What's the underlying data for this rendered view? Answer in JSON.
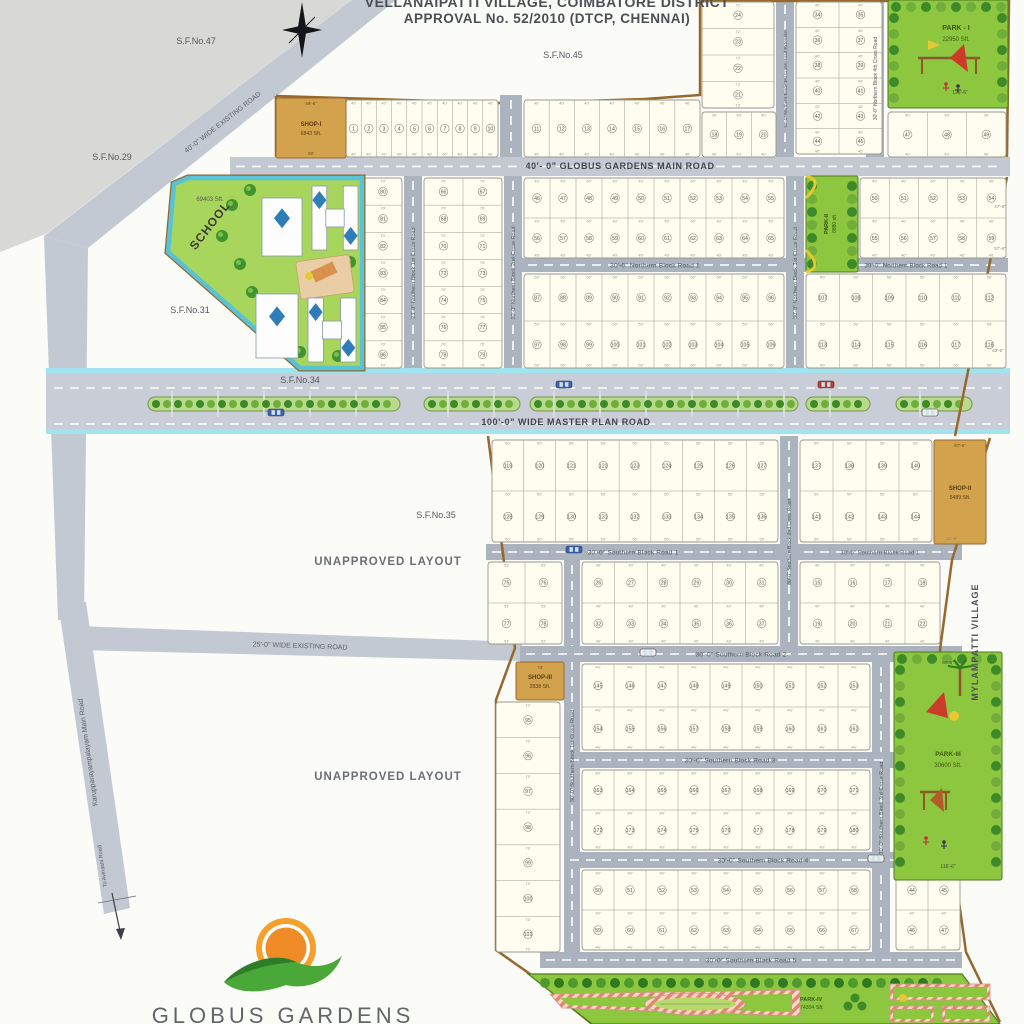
{
  "header": {
    "line1": "VELLANAIPATTI VILLAGE, COIMBATORE DISTRICT",
    "line2": "APPROVAL No. 52/2010 (DTCP, CHENNAI)"
  },
  "logo": {
    "name": "GLOBUS GARDENS"
  },
  "colors": {
    "road": "#c3c9d3",
    "road_dark": "#aab3be",
    "master_road": "#c8cdd7",
    "cyan": "#9fe4ee",
    "boundary": "#96682c",
    "plot_fill": "#fffdf0",
    "plot_stroke": "#9a9a8c",
    "park_green": "#8dc63f",
    "tree_dark": "#3c8a28",
    "tree_light": "#6fae3a",
    "shop_tan": "#d2a24c",
    "text": "#555555",
    "median_bg": "#b9d98c"
  },
  "map": {
    "labels": {
      "survey": [
        {
          "text": "S.F.No.47",
          "x": 196,
          "y": 44
        },
        {
          "text": "S.F.No.45",
          "x": 563,
          "y": 58
        },
        {
          "text": "S.F.No.29",
          "x": 112,
          "y": 160
        },
        {
          "text": "S.F.No.31",
          "x": 190,
          "y": 313
        },
        {
          "text": "S.F.No.34",
          "x": 300,
          "y": 383
        },
        {
          "text": "S.F.No.35",
          "x": 436,
          "y": 518
        }
      ],
      "area": [
        {
          "text": "UNAPPROVED LAYOUT",
          "x": 388,
          "y": 565
        },
        {
          "text": "UNAPPROVED LAYOUT",
          "x": 388,
          "y": 780
        }
      ],
      "village": {
        "text": "MYLAMPATTI VILLAGE",
        "x": 978,
        "y": 642
      },
      "to_arrow": {
        "text": "To Avinashi Road",
        "x": 104,
        "y": 866,
        "rot": -98
      },
      "edge_dims": [
        {
          "t": "47'-6\"",
          "x": 1000,
          "y": 208
        },
        {
          "t": "57'-6\"",
          "x": 1000,
          "y": 250
        },
        {
          "t": "62'-6\"",
          "x": 998,
          "y": 352
        },
        {
          "t": "42'-6\"",
          "x": 952,
          "y": 540
        }
      ]
    },
    "roads": {
      "polygons": [
        {
          "name": "wide-existing-road-40",
          "points": "352,0 396,0 88,248 44,236",
          "label": "40'-0\" WIDE EXISTING ROAD",
          "lx": 224,
          "ly": 124,
          "rot": -38,
          "fs": 7
        },
        {
          "name": "left-link-road",
          "points": "44,236 88,248 84,620 58,620",
          "label": "",
          "lx": 0,
          "ly": 0,
          "rot": 0,
          "fs": 0
        },
        {
          "name": "karuppanarayampalayam-main-road",
          "points": "58,602 86,602 130,908 104,914",
          "label": "Karupparayampalayam Main Road",
          "lx": 90,
          "ly": 752,
          "rot": -98,
          "fs": 7
        },
        {
          "name": "wide-existing-road-25",
          "points": "76,626 522,642 522,661 78,650",
          "label": "25'-0\" WIDE EXISTING ROAD",
          "lx": 300,
          "ly": 648,
          "rot": 2,
          "fs": 7
        }
      ],
      "horizontal": [
        {
          "name": "globus-gardens-main-road",
          "x": 230,
          "y": 157,
          "w": 780,
          "h": 19,
          "label": "40'- 0\" GLOBUS GARDENS MAIN ROAD",
          "fs": 9,
          "bold": true
        },
        {
          "name": "northern-block-road-1-center",
          "x": 522,
          "y": 258,
          "w": 266,
          "h": 14,
          "label": "30'-0\" Northern Block Road 1",
          "fs": 6.5
        },
        {
          "name": "northern-block-road-1-right",
          "x": 804,
          "y": 258,
          "w": 204,
          "h": 14,
          "label": "30'-0\" Northern Block Road 1",
          "fs": 6
        },
        {
          "name": "southern-block-road-1-left",
          "x": 486,
          "y": 544,
          "w": 294,
          "h": 16,
          "label": "30'-0\" Southern Block Road 1",
          "fs": 6.5
        },
        {
          "name": "southern-block-road-1-right",
          "x": 798,
          "y": 544,
          "w": 164,
          "h": 16,
          "label": "30'-0\" Southern Block Road 1",
          "fs": 5.6
        },
        {
          "name": "southern-block-road-2",
          "x": 520,
          "y": 646,
          "w": 442,
          "h": 16,
          "label": "30'-0\" Southern Block Road 2",
          "fs": 6.5
        },
        {
          "name": "southern-block-road-3",
          "x": 564,
          "y": 752,
          "w": 332,
          "h": 16,
          "label": "30'-0\" Southern Block Road 3",
          "fs": 6.5
        },
        {
          "name": "southern-block-road-4",
          "x": 564,
          "y": 852,
          "w": 398,
          "h": 16,
          "label": "30'-0\" Southern Block Road 4",
          "fs": 6.5
        },
        {
          "name": "southern-block-road-5",
          "x": 540,
          "y": 952,
          "w": 422,
          "h": 16,
          "label": "30'-0\" Southern Block Road 5",
          "fs": 6.5
        }
      ],
      "vertical": [
        {
          "name": "entry-road-stub",
          "x": 500,
          "y": 95,
          "w": 22,
          "h": 63,
          "label": "",
          "fs": 0
        },
        {
          "name": "northern-block-1st-cross-road",
          "x": 404,
          "y": 176,
          "w": 18,
          "h": 194,
          "label": "23'-0\" Northern Block 1st Cross Road",
          "fs": 5.5
        },
        {
          "name": "northern-block-2nd-cross-road",
          "x": 504,
          "y": 176,
          "w": 18,
          "h": 194,
          "label": "30'-0\" Northern Block 2nd Cross Road",
          "fs": 5.5
        },
        {
          "name": "northern-block-3rd-cross-road",
          "x": 786,
          "y": 176,
          "w": 18,
          "h": 194,
          "label": "30'-0\" Northern Block 3rd Cross Road",
          "fs": 5.5
        },
        {
          "name": "northern-block-3rd-cross-road-extension",
          "x": 776,
          "y": 0,
          "w": 18,
          "h": 157,
          "label": "30'-0\" Northern Block 3rd Cross Road Extension",
          "fs": 4.6
        },
        {
          "name": "northern-block-4th-cross-road",
          "x": 866,
          "y": 0,
          "w": 18,
          "h": 157,
          "label": "30'-0\" Northern Block 4th Cross Road",
          "fs": 5
        },
        {
          "name": "southern-block-1st-cross-road",
          "x": 564,
          "y": 560,
          "w": 16,
          "h": 392,
          "label": "30'-0\" Southern Block 1st Cross Road",
          "fs": 5.5
        },
        {
          "name": "southern-block-2nd-cross-road",
          "x": 780,
          "y": 436,
          "w": 18,
          "h": 212,
          "label": "30'-0\" Southern Block 2nd Cross Road",
          "fs": 5
        },
        {
          "name": "southern-block-3rd-cross-road",
          "x": 872,
          "y": 662,
          "w": 18,
          "h": 292,
          "label": "30'-0\" Southern Block 3rd Cross Road",
          "fs": 5.5
        }
      ],
      "master": {
        "name": "master-plan-road",
        "x": 46,
        "y": 368,
        "w": 964,
        "h": 66,
        "label": "100'-0\" WIDE MASTER PLAN ROAD",
        "lx": 566,
        "ly": 425
      }
    },
    "medians": [
      {
        "x": 148,
        "w": 252
      },
      {
        "x": 424,
        "w": 96
      },
      {
        "x": 530,
        "w": 268
      },
      {
        "x": 806,
        "w": 64
      },
      {
        "x": 896,
        "w": 76
      }
    ],
    "cars": [
      {
        "x": 268,
        "y": 409,
        "c": "#3a62b8"
      },
      {
        "x": 556,
        "y": 381,
        "c": "#3a62b8"
      },
      {
        "x": 818,
        "y": 381,
        "c": "#c0392b"
      },
      {
        "x": 922,
        "y": 409,
        "c": "#eeeeee"
      },
      {
        "x": 566,
        "y": 546,
        "c": "#3a62b8"
      },
      {
        "x": 640,
        "y": 649,
        "c": "#eeeeee"
      },
      {
        "x": 868,
        "y": 855,
        "c": "#eeeeee"
      }
    ],
    "blocks": [
      {
        "x": 346,
        "y": 100,
        "w": 152,
        "h": 57,
        "cols": 10,
        "rows": 1,
        "start": 1,
        "dim": "40'"
      },
      {
        "x": 524,
        "y": 100,
        "w": 176,
        "h": 57,
        "cols": 7,
        "rows": 1,
        "start": 11,
        "dim": "40'"
      },
      {
        "x": 702,
        "y": 112,
        "w": 74,
        "h": 45,
        "cols": 3,
        "rows": 1,
        "start": 18,
        "dim": "40'"
      },
      {
        "x": 702,
        "y": 2,
        "w": 72,
        "h": 106,
        "cols": 1,
        "rows": 4,
        "start": 21,
        "desc": true,
        "dim": "72'"
      },
      {
        "x": 796,
        "y": 2,
        "w": 86,
        "h": 152,
        "cols": 2,
        "rows": 6,
        "start": 34,
        "dim": "40'"
      },
      {
        "x": 888,
        "y": 112,
        "w": 118,
        "h": 45,
        "cols": 3,
        "rows": 1,
        "start": 47,
        "dim": "40'"
      },
      {
        "x": 364,
        "y": 178,
        "w": 38,
        "h": 190,
        "cols": 1,
        "rows": 7,
        "start": 80,
        "dim": "70'"
      },
      {
        "x": 424,
        "y": 178,
        "w": 78,
        "h": 190,
        "cols": 2,
        "rows": 7,
        "start": 66,
        "dim": "70'"
      },
      {
        "x": 524,
        "y": 178,
        "w": 260,
        "h": 80,
        "cols": 10,
        "rows": 2,
        "start": 46,
        "dim": "40'"
      },
      {
        "x": 524,
        "y": 274,
        "w": 260,
        "h": 94,
        "cols": 10,
        "rows": 2,
        "start": 87,
        "dim": "50'"
      },
      {
        "x": 860,
        "y": 178,
        "w": 146,
        "h": 80,
        "cols": 5,
        "rows": 2,
        "start": 50,
        "dim": "40'"
      },
      {
        "x": 806,
        "y": 274,
        "w": 200,
        "h": 94,
        "cols": 6,
        "rows": 2,
        "start": 107,
        "dim": "50'"
      },
      {
        "x": 492,
        "y": 440,
        "w": 286,
        "h": 102,
        "cols": 9,
        "rows": 2,
        "start": 119,
        "dim": "50'"
      },
      {
        "x": 800,
        "y": 440,
        "w": 132,
        "h": 102,
        "cols": 4,
        "rows": 2,
        "start": 137,
        "dim": "50'"
      },
      {
        "x": 488,
        "y": 562,
        "w": 74,
        "h": 82,
        "cols": 2,
        "rows": 2,
        "start": 75,
        "dim": "53'"
      },
      {
        "x": 582,
        "y": 562,
        "w": 196,
        "h": 82,
        "cols": 6,
        "rows": 2,
        "start": 26,
        "dim": "40'"
      },
      {
        "x": 800,
        "y": 562,
        "w": 140,
        "h": 82,
        "cols": 4,
        "rows": 2,
        "start": 15,
        "dim": "40'"
      },
      {
        "x": 496,
        "y": 702,
        "w": 64,
        "h": 250,
        "cols": 1,
        "rows": 7,
        "start": 95,
        "dim": "73'"
      },
      {
        "x": 582,
        "y": 664,
        "w": 288,
        "h": 86,
        "cols": 9,
        "rows": 2,
        "start": 145,
        "dim": "40'"
      },
      {
        "x": 582,
        "y": 770,
        "w": 288,
        "h": 80,
        "cols": 9,
        "rows": 2,
        "start": 163,
        "dim": "40'"
      },
      {
        "x": 582,
        "y": 870,
        "w": 288,
        "h": 80,
        "cols": 9,
        "rows": 2,
        "start": 50,
        "dim": "40'"
      },
      {
        "x": 896,
        "y": 870,
        "w": 64,
        "h": 80,
        "cols": 2,
        "rows": 2,
        "start": 44,
        "dim": "40'"
      }
    ],
    "shops": [
      {
        "name": "SHOP-I",
        "area": "6843 Sft.",
        "x": 276,
        "y": 98,
        "w": 70,
        "h": 60,
        "dim_top": "48'-6\"",
        "dim_bottom": "80'"
      },
      {
        "name": "SHOP-II",
        "area": "5489 Sft.",
        "x": 934,
        "y": 440,
        "w": 52,
        "h": 104,
        "dim_top": "87'-6\"",
        "dim_bottom": ""
      },
      {
        "name": "SHOP-III",
        "area": "2838 Sft.",
        "x": 516,
        "y": 662,
        "w": 48,
        "h": 38,
        "dim_top": "74'",
        "dim_bottom": ""
      }
    ],
    "parks": [
      {
        "name": "PARK - I",
        "area": "22950 Sft.",
        "dim": "125'-6\"",
        "x": 888,
        "y": 0,
        "w": 120,
        "h": 108,
        "kind": "playground"
      },
      {
        "name": "PARK-II",
        "area": "8880 sft",
        "dim": "",
        "x": 806,
        "y": 176,
        "w": 52,
        "h": 96,
        "kind": "vertical"
      },
      {
        "name": "PARK-III",
        "area": "30600 Sft.",
        "dim": "116'-6\"",
        "dim_top": "87'-6\"",
        "x": 894,
        "y": 652,
        "w": 108,
        "h": 228,
        "kind": "playground-tall"
      },
      {
        "name": "PARK-IV",
        "area": "74304 Sft.",
        "poly": "528,974 962,974 1000,1024 592,1024",
        "lx": 800,
        "ly": 1001,
        "kind": "garden"
      }
    ],
    "school": {
      "label": "SCHOOL",
      "area": "69403 Sft.",
      "poly": "188,178 362,178 362,368 300,368 168,252 174,184",
      "label_x": 213,
      "label_y": 228,
      "label_rot": -52,
      "area_x": 210,
      "area_y": 201
    }
  }
}
